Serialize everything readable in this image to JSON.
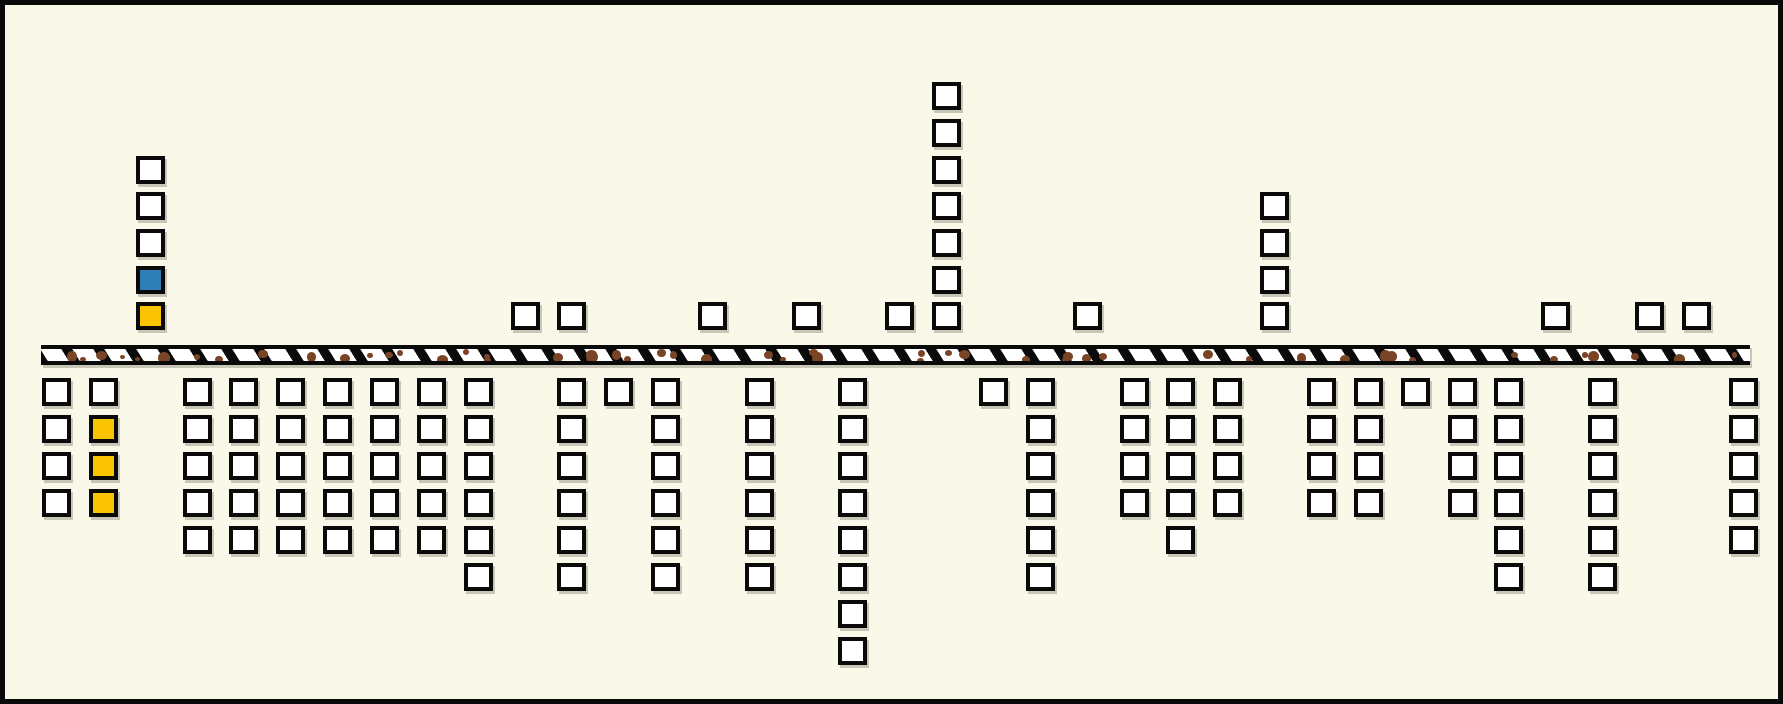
{
  "scene": {
    "canvas": {
      "width": 1783,
      "height": 704,
      "background": "#FAF8E9",
      "frame_color": "#0A0A0A",
      "frame_width": 5
    },
    "palette": {
      "tile_fill": "#FFFFFF",
      "tile_border": "#0A0A0A",
      "blue": "#2E7EB8",
      "yellow": "#FBC402",
      "soil_dot_brown": "#7A4526",
      "bar_fill": "#FFFFFF",
      "shadow": "#C8C6B6"
    },
    "grid": {
      "col_origin_x": 37,
      "col_pitch": 46.85,
      "num_cols": 37,
      "tile_width": 29,
      "tile_height": 28,
      "above_row_ys": [
        77,
        114,
        151,
        187,
        224,
        261,
        297
      ],
      "below_first_row_y": 373,
      "below_row_pitch": 37
    },
    "ground_bar": {
      "x": 36,
      "y": 340,
      "width": 1709,
      "height": 20,
      "hatch_bar_width": 11,
      "hatch_gap": 21,
      "dot_count": 55
    }
  },
  "above_ground_stacks": [
    {
      "col": 2,
      "start_row": 2,
      "cells": [
        "white",
        "white",
        "white",
        "blue",
        "yellow"
      ]
    },
    {
      "col": 10,
      "start_row": 6,
      "cells": [
        "white"
      ]
    },
    {
      "col": 11,
      "start_row": 6,
      "cells": [
        "white"
      ]
    },
    {
      "col": 14,
      "start_row": 6,
      "cells": [
        "white"
      ]
    },
    {
      "col": 16,
      "start_row": 6,
      "cells": [
        "white"
      ]
    },
    {
      "col": 18,
      "start_row": 6,
      "cells": [
        "white"
      ]
    },
    {
      "col": 19,
      "start_row": 0,
      "cells": [
        "white",
        "white",
        "white",
        "white",
        "white",
        "white",
        "white"
      ]
    },
    {
      "col": 22,
      "start_row": 6,
      "cells": [
        "white"
      ]
    },
    {
      "col": 26,
      "start_row": 3,
      "cells": [
        "white",
        "white",
        "white",
        "white"
      ]
    },
    {
      "col": 32,
      "start_row": 6,
      "cells": [
        "white"
      ]
    },
    {
      "col": 34,
      "start_row": 6,
      "cells": [
        "white"
      ]
    },
    {
      "col": 35,
      "start_row": 6,
      "cells": [
        "white"
      ]
    }
  ],
  "below_ground_columns": [
    {
      "col": 0,
      "cells": [
        "white",
        "white",
        "white",
        "white"
      ]
    },
    {
      "col": 1,
      "cells": [
        "white",
        "yellow",
        "yellow",
        "yellow"
      ]
    },
    {
      "col": 3,
      "cells": [
        "white",
        "white",
        "white",
        "white",
        "white"
      ]
    },
    {
      "col": 4,
      "cells": [
        "white",
        "white",
        "white",
        "white",
        "white"
      ]
    },
    {
      "col": 5,
      "cells": [
        "white",
        "white",
        "white",
        "white",
        "white"
      ]
    },
    {
      "col": 6,
      "cells": [
        "white",
        "white",
        "white",
        "white",
        "white"
      ]
    },
    {
      "col": 7,
      "cells": [
        "white",
        "white",
        "white",
        "white",
        "white"
      ]
    },
    {
      "col": 8,
      "cells": [
        "white",
        "white",
        "white",
        "white",
        "white"
      ]
    },
    {
      "col": 9,
      "cells": [
        "white",
        "white",
        "white",
        "white",
        "white",
        "white"
      ]
    },
    {
      "col": 11,
      "cells": [
        "white",
        "white",
        "white",
        "white",
        "white",
        "white"
      ]
    },
    {
      "col": 12,
      "cells": [
        "white"
      ]
    },
    {
      "col": 13,
      "cells": [
        "white",
        "white",
        "white",
        "white",
        "white",
        "white"
      ]
    },
    {
      "col": 15,
      "cells": [
        "white",
        "white",
        "white",
        "white",
        "white",
        "white"
      ]
    },
    {
      "col": 17,
      "cells": [
        "white",
        "white",
        "white",
        "white",
        "white",
        "white",
        "white",
        "white"
      ]
    },
    {
      "col": 20,
      "cells": [
        "white"
      ]
    },
    {
      "col": 21,
      "cells": [
        "white",
        "white",
        "white",
        "white",
        "white",
        "white"
      ]
    },
    {
      "col": 23,
      "cells": [
        "white",
        "white",
        "white",
        "white"
      ]
    },
    {
      "col": 24,
      "cells": [
        "white",
        "white",
        "white",
        "white",
        "white"
      ]
    },
    {
      "col": 25,
      "cells": [
        "white",
        "white",
        "white",
        "white"
      ]
    },
    {
      "col": 27,
      "cells": [
        "white",
        "white",
        "white",
        "white"
      ]
    },
    {
      "col": 28,
      "cells": [
        "white",
        "white",
        "white",
        "white"
      ]
    },
    {
      "col": 29,
      "cells": [
        "white"
      ]
    },
    {
      "col": 30,
      "cells": [
        "white",
        "white",
        "white",
        "white"
      ]
    },
    {
      "col": 31,
      "cells": [
        "white",
        "white",
        "white",
        "white",
        "white",
        "white"
      ]
    },
    {
      "col": 33,
      "cells": [
        "white",
        "white",
        "white",
        "white",
        "white",
        "white"
      ]
    },
    {
      "col": 36,
      "cells": [
        "white",
        "white",
        "white",
        "white",
        "white"
      ]
    }
  ]
}
